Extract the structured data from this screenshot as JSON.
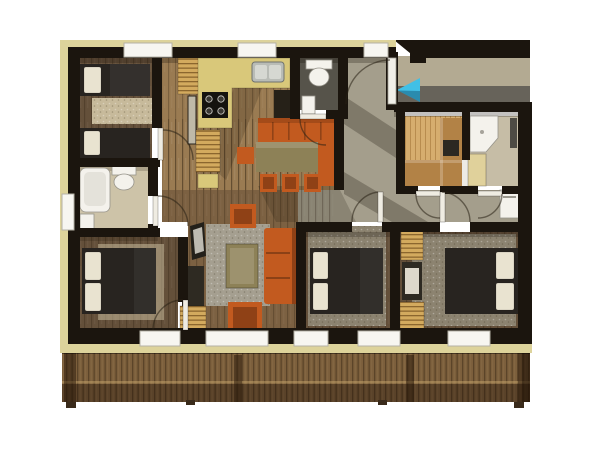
{
  "palette": {
    "bg": "#ffffff",
    "trim": "#ddd39b",
    "wall": "#1b150e",
    "wood-light": "#9a7b52",
    "wood-mid": "#7c6142",
    "wood-dark": "#64503a",
    "tile": "#cdc3a8",
    "tile2": "#c6bda6",
    "slate": "#56534a",
    "hall": "#a49e8c",
    "bed": "#282420",
    "pillow": "#e9e3d0",
    "orange": "#c25a1f",
    "orange-dark": "#8f4116",
    "olive": "#8d8157",
    "counter": "#d9c87a",
    "closet": "#d3aa5e",
    "sauna-wood": "#d6ad6e",
    "sauna-bench": "#b28246",
    "fixture": "#f4f2ec",
    "porch-floor": "#b3aa92",
    "porch-shadow": "#67635a",
    "arrow": "#41c0e6",
    "deck-wood": "#7c5f3c",
    "rug-beige": "#c7ba9b",
    "rug-gray": "#a59f90",
    "rug-tan": "#8c8370"
  },
  "floorplan": {
    "type": "3d-rendered apartment floor plan, top-down view",
    "rooms": [
      "twin bedroom (top left)",
      "bathroom (left)",
      "double bedroom (bottom left)",
      "kitchen and dining (top center)",
      "wc (top center)",
      "living room (center)",
      "double bedroom (bottom center)",
      "double bedroom (bottom right)",
      "sauna (right)",
      "shower room (right)",
      "entrance hall (top right)",
      "balcony deck (bottom)"
    ],
    "furniture": [
      "2 single beds",
      "3 double beds",
      "bathtub",
      "2 toilets",
      "kitchen counter with hob and sink",
      "dining table with orange bench and stools",
      "orange sofa",
      "2 orange armchairs",
      "coffee table",
      "tv sideboard",
      "striped wardrobes",
      "sauna benches and stove",
      "shower tray",
      "washing machine"
    ],
    "entrance_arrow": {
      "shape": "triangle",
      "points_direction": "left",
      "color": "#41c0e6"
    }
  }
}
